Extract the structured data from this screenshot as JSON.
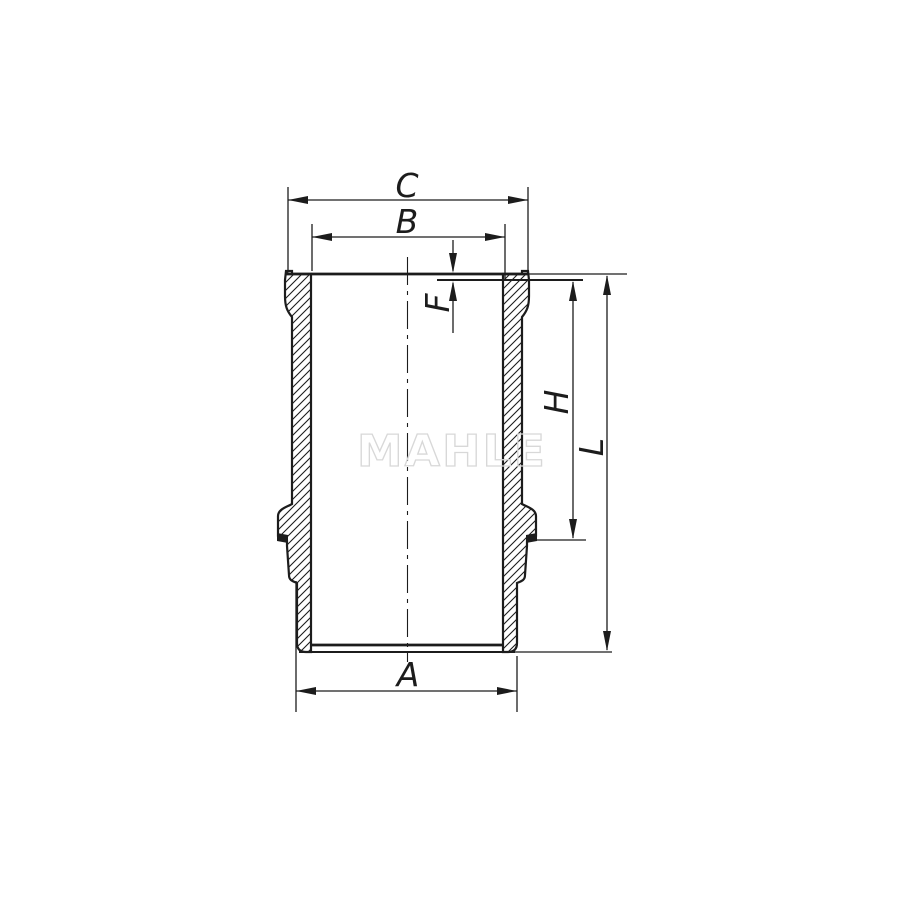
{
  "colors": {
    "line": "#1c1c1c",
    "watermark_outline": "#d8d8d8",
    "background": "#ffffff"
  },
  "watermark": {
    "text": "MAHLE"
  },
  "dimensions": {
    "c": {
      "label": "C"
    },
    "b": {
      "label": "B"
    },
    "f": {
      "label": "F"
    },
    "h": {
      "label": "H"
    },
    "l": {
      "label": "L"
    },
    "a": {
      "label": "A"
    }
  }
}
